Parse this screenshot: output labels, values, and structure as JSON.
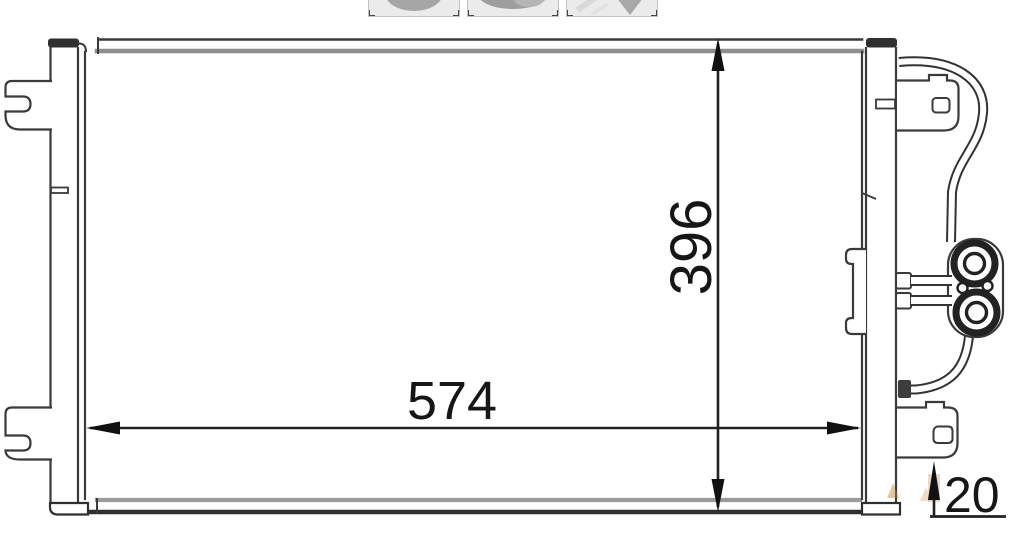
{
  "canvas": {
    "background": "#ffffff"
  },
  "thumbnail_strip": {
    "items": [
      {
        "name": "product-thumbnail-1",
        "icon": "condenser-photo-thumb"
      },
      {
        "name": "product-thumbnail-2",
        "icon": "condenser-photo-thumb"
      },
      {
        "name": "product-thumbnail-3",
        "icon": "condenser-photo-thumb"
      }
    ]
  },
  "diagram": {
    "subject": "ac-condenser-dimensional-drawing",
    "line_color": "#2f2f2f",
    "shade_color": "#8e8e8e",
    "text_color": "#161616",
    "watermark_color": "#c08437",
    "dimensions": {
      "height_mm": "396",
      "width_mm": "574",
      "depth_mm": "20"
    }
  }
}
